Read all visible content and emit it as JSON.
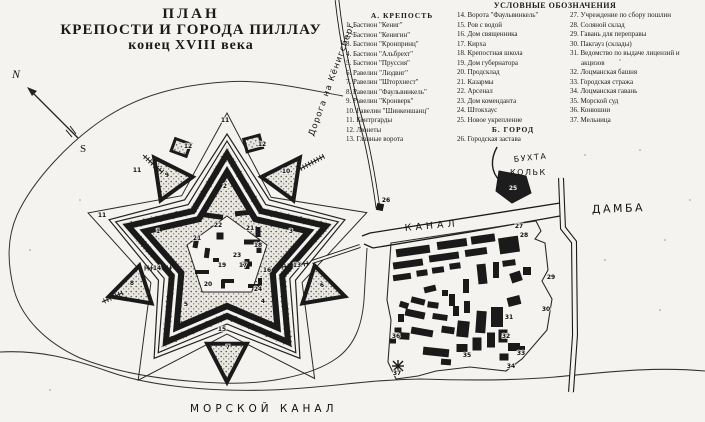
{
  "title": {
    "line1": "ПЛАН",
    "line2": "КРЕПОСТИ И ГОРОДА ПИЛЛАУ",
    "line3": "конец XVIII века"
  },
  "legend": {
    "header": "УСЛОВНЫЕ ОБОЗНАЧЕНИЯ",
    "section_a": "А. КРЕПОСТЬ",
    "section_b": "Б. ГОРОД",
    "col1": [
      "1. Бастион \"Кениг\"",
      "2. Бастион \"Кенигин\"",
      "3. Бастион \"Кронпринц\"",
      "4. Бастион \"Альбрехт\"",
      "5. Бастион \"Пруссия\"",
      "6. Равелин \"Людвиг\"",
      "7. Равелин \"Шторхнест\"",
      "8. Равелин \"Фаульвинкель\"",
      "9. Равелин \"Кронверк\"",
      "10. Равелин \"Шинкеншанц\"",
      "11. Контргарды",
      "12. Люнеты",
      "13. Главные ворота"
    ],
    "col2_part1": [
      "14. Ворота \"Фаульвинкель\"",
      "15. Ров с водой",
      "16. Дом священника",
      "17. Кирха",
      "18. Крепостная школа",
      "19. Дом губернатора",
      "20. Продсклад",
      "21. Казармы",
      "22. Арсенал",
      "23. Дом коменданта",
      "24. Штокхаус",
      "25. Новое укрепление"
    ],
    "col2_part2": [
      "26. Городская застава"
    ],
    "col3": [
      "27. Учреждение по сбору пошлин",
      "28. Соляной склад",
      "29. Гавань для переправы",
      "30. Пакгауз (склады)",
      "31. Ведомство по выдаче лицензий и акцизов",
      "32. Лоцманская башня",
      "33. Городская стража",
      "34. Лоцманская гавань",
      "35. Морской суд",
      "36. Конюшни",
      "37. Мельница"
    ]
  },
  "map_labels": {
    "canal": "КАНАЛ",
    "sea_canal": "МОРСКОЙ  КАНАЛ",
    "dam": "ДАМБА",
    "bay_line1": "БУХТА",
    "bay_line2": "КОЛЬК",
    "road": "Дорога на Кёнигсберг",
    "compass_n": "N",
    "compass_s": "S"
  },
  "colors": {
    "paper": "#f4f3ef",
    "ink": "#1a1a1a"
  },
  "map_numbers": [
    [
      "1",
      158,
      233
    ],
    [
      "2",
      225,
      188
    ],
    [
      "3",
      291,
      233
    ],
    [
      "4",
      263,
      303
    ],
    [
      "5",
      186,
      306
    ],
    [
      "6",
      322,
      287
    ],
    [
      "7",
      228,
      349
    ],
    [
      "8",
      132,
      285
    ],
    [
      "9",
      167,
      177
    ],
    [
      "10",
      286,
      173
    ],
    [
      "11",
      137,
      172
    ],
    [
      "11",
      102,
      217
    ],
    [
      "11",
      225,
      122
    ],
    [
      "12",
      188,
      148
    ],
    [
      "12",
      262,
      146
    ],
    [
      "13",
      297,
      267
    ],
    [
      "14",
      157,
      270
    ],
    [
      "15",
      222,
      331
    ],
    [
      "16",
      267,
      272
    ],
    [
      "17",
      243,
      267
    ],
    [
      "18",
      258,
      247
    ],
    [
      "19",
      222,
      267
    ],
    [
      "20",
      208,
      286
    ],
    [
      "21",
      197,
      240
    ],
    [
      "21",
      250,
      230
    ],
    [
      "22",
      218,
      227
    ],
    [
      "23",
      237,
      257
    ],
    [
      "24",
      258,
      291
    ],
    [
      "26",
      386,
      202
    ],
    [
      "27",
      519,
      228
    ],
    [
      "28",
      524,
      237
    ],
    [
      "29",
      551,
      279
    ],
    [
      "30",
      546,
      311
    ],
    [
      "31",
      509,
      319
    ],
    [
      "32",
      506,
      338
    ],
    [
      "33",
      521,
      355
    ],
    [
      "34",
      511,
      368
    ],
    [
      "35",
      467,
      357
    ],
    [
      "36",
      396,
      338
    ],
    [
      "37",
      397,
      375
    ]
  ],
  "map_numbers_light": [
    [
      "25",
      513,
      190
    ]
  ]
}
